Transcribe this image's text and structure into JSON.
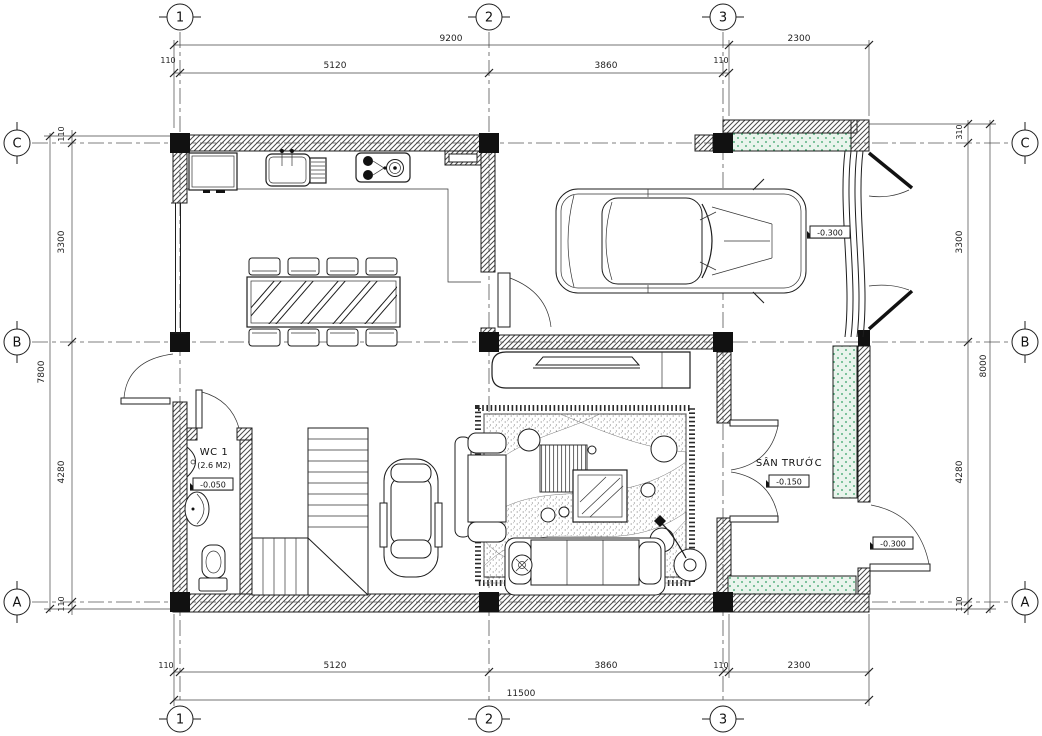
{
  "axes": {
    "cols": [
      "1",
      "2",
      "3"
    ],
    "rows": [
      "C",
      "B",
      "A"
    ]
  },
  "dims": {
    "top_totals": [
      "9200",
      "2300"
    ],
    "top_segments": [
      "110",
      "5120",
      "3860",
      "110"
    ],
    "bottom_segments": [
      "110",
      "5120",
      "3860",
      "110",
      "2300"
    ],
    "bottom_total": "11500",
    "left_segments": [
      "110",
      "3300",
      "4280",
      "110"
    ],
    "left_total": "7800",
    "right_segments": [
      "310",
      "3300",
      "4280",
      "110"
    ],
    "right_total": "8000"
  },
  "rooms": {
    "wc": {
      "name": "WC 1",
      "area": "(2.6 M2)",
      "level": "-0.050"
    },
    "front_yard": {
      "name": "SÂN TRƯỚC",
      "level": "-0.150"
    },
    "garage": {
      "level": "-0.300"
    },
    "gate": {
      "level": "-0.300"
    }
  },
  "colors": {
    "ink": "#1d1d1d",
    "hatch": "#4a4a4a",
    "green": "#2f9e62",
    "green_bg": "#e9f4ec"
  }
}
